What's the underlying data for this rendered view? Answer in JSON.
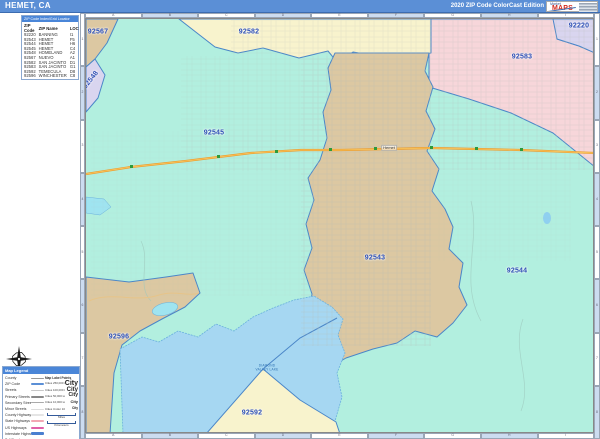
{
  "title_bar": {
    "title": "HEMET, CA",
    "edition": "2020 ZIP Code ColorCast Edition",
    "logo_top": "Market",
    "logo_main": "MAPS"
  },
  "index_panel": {
    "header": "ZIP Code Index/Grid Locator",
    "columns": [
      "ZIP Code",
      "ZIP Name",
      "LOC"
    ],
    "rows": [
      [
        "92220",
        "BANNING",
        "I1"
      ],
      [
        "92543",
        "HEMET",
        "F5"
      ],
      [
        "92544",
        "HEMET",
        "H6"
      ],
      [
        "92545",
        "HEMET",
        "C4"
      ],
      [
        "92548",
        "HOMELAND",
        "A2"
      ],
      [
        "92567",
        "NUEVO",
        "A1"
      ],
      [
        "92582",
        "SAN JACINTO",
        "D1"
      ],
      [
        "92583",
        "SAN JACINTO",
        "G1"
      ],
      [
        "92592",
        "TEMECULA",
        "D8"
      ],
      [
        "92596",
        "WINCHESTER",
        "C8"
      ]
    ]
  },
  "map": {
    "zip_labels": [
      {
        "code": "92567",
        "x": 97,
        "y": 31,
        "rotate": 0
      },
      {
        "code": "92548",
        "x": 90,
        "y": 79,
        "rotate": -52
      },
      {
        "code": "92582",
        "x": 248,
        "y": 31,
        "rotate": 0
      },
      {
        "code": "92583",
        "x": 521,
        "y": 56,
        "rotate": 0
      },
      {
        "code": "92220",
        "x": 578,
        "y": 25,
        "rotate": 0
      },
      {
        "code": "92545",
        "x": 213,
        "y": 132,
        "rotate": 0
      },
      {
        "code": "92543",
        "x": 374,
        "y": 257,
        "rotate": 0
      },
      {
        "code": "92544",
        "x": 516,
        "y": 270,
        "rotate": 0
      },
      {
        "code": "92596",
        "x": 118,
        "y": 336,
        "rotate": 0
      },
      {
        "code": "92592",
        "x": 251,
        "y": 412,
        "rotate": 0
      }
    ],
    "city_label": {
      "name": "Hemet",
      "x": 388,
      "y": 147
    },
    "lake_label": {
      "name": "DIAMOND VALLEY LAKE",
      "x": 266,
      "y": 367
    },
    "grid_columns": [
      "A",
      "B",
      "C",
      "D",
      "E",
      "F",
      "G",
      "H",
      "I"
    ],
    "grid_rows": [
      "1",
      "2",
      "3",
      "4",
      "5",
      "6",
      "7",
      "8"
    ],
    "colors": {
      "teal": "#b2efdf",
      "tan": "#dcc8a2",
      "yellow": "#f8f3cd",
      "pink": "#f7d6da",
      "lavender": "#d9d5ef",
      "lake": "#a6d7f2",
      "boundary": "#4a86c8",
      "highway": "#eda032"
    }
  },
  "legend": {
    "title": "Map Legend",
    "items": [
      {
        "label": "County",
        "color": "#999999",
        "h": 1
      },
      {
        "label": "ZIP Code",
        "color": "#5b8fd6",
        "h": 2
      },
      {
        "label": "Streets",
        "color": "#c8c8c8",
        "h": 1
      },
      {
        "label": "Primary Streets",
        "color": "#888888",
        "h": 2
      },
      {
        "label": "Secondary Streets",
        "color": "#aaaaaa",
        "h": 1
      },
      {
        "label": "Minor Streets",
        "color": "#dddddd",
        "h": 1
      },
      {
        "label": "County Highways",
        "color": "#e5e5e5",
        "h": 2
      },
      {
        "label": "State Highways",
        "color": "#f2a7b4",
        "h": 2
      },
      {
        "label": "US Highways",
        "color": "#e060a8",
        "h": 2
      },
      {
        "label": "Interstate Highways",
        "color": "#4a7fd0",
        "h": 3
      },
      {
        "label": "Toll Roads",
        "color": "#4fc87a",
        "h": 2
      }
    ],
    "label_points": {
      "title": "Map Label Points",
      "rows": [
        {
          "label": "Cities 250,000 & Over",
          "sample": "City",
          "size": 7
        },
        {
          "label": "Cities 100,000 to 249,999",
          "sample": "City",
          "size": 6
        },
        {
          "label": "Cities 50,000 to 99,999",
          "sample": "City",
          "size": 5
        },
        {
          "label": "Cities 10,000 to 49,999",
          "sample": "City",
          "size": 4
        },
        {
          "label": "Cities Under 10,000",
          "sample": "City",
          "size": 3.2
        }
      ],
      "scales": [
        "Miles",
        "Kilometers"
      ]
    }
  }
}
